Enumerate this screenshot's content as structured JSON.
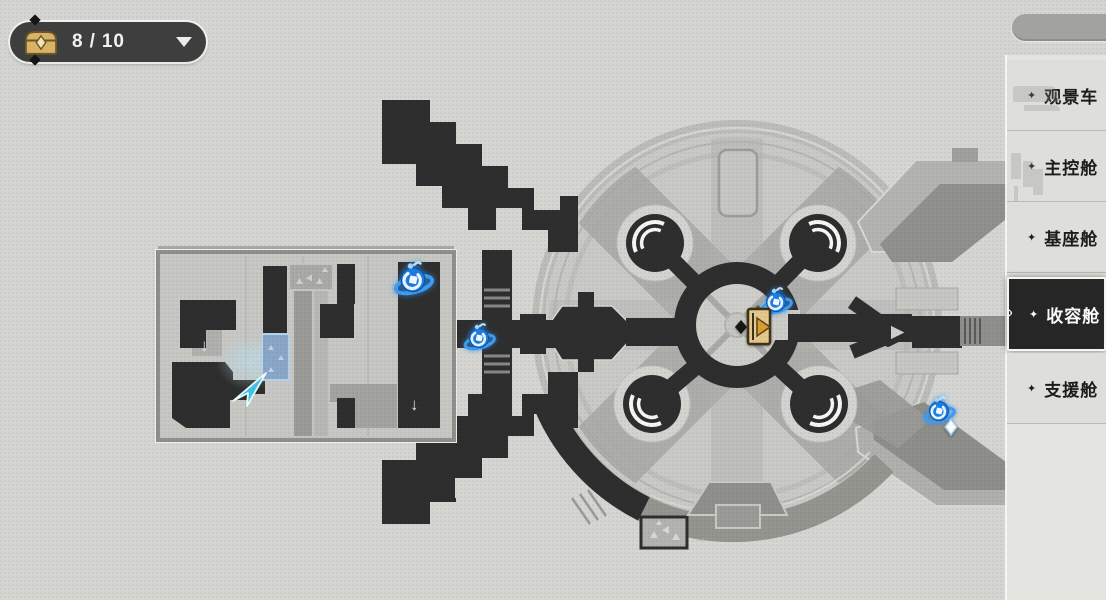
{
  "treasure_counter": {
    "current": "8",
    "separator": "/",
    "total": "10",
    "chest_icon": "treasure-chest",
    "dropdown_icon": "caret-down"
  },
  "top_right_pill": {
    "label": ""
  },
  "zone_list": {
    "star_glyph": "✦",
    "selected_indicator": "≫",
    "items": [
      {
        "label": "观景车",
        "selected": false
      },
      {
        "label": "主控舱",
        "selected": false
      },
      {
        "label": "基座舱",
        "selected": false
      },
      {
        "label": "收容舱",
        "selected": true
      },
      {
        "label": "支援舱",
        "selected": false
      }
    ]
  },
  "map": {
    "icons": {
      "down_arrow": "↓",
      "right_arrow": "→"
    },
    "markers": {
      "space_anchors": [
        {
          "x": 413,
          "y": 281,
          "scale": 1.25
        },
        {
          "x": 479,
          "y": 339,
          "scale": 1.0
        },
        {
          "x": 776,
          "y": 303,
          "scale": 1.0
        },
        {
          "x": 939,
          "y": 412,
          "scale": 1.0
        }
      ],
      "exit_marker": {
        "x": 757,
        "y": 326
      },
      "player_marker": {
        "x": 249,
        "y": 389
      },
      "waypoint_diamond": {
        "x": 951,
        "y": 427
      }
    },
    "colors": {
      "anchor_blue": "#1d7de0",
      "player_cyan": "#3ec3e9",
      "exit_gold": "#e6c78c",
      "selected_zone_bg": "#262626",
      "wall_dark": "#2e2e2e"
    }
  }
}
